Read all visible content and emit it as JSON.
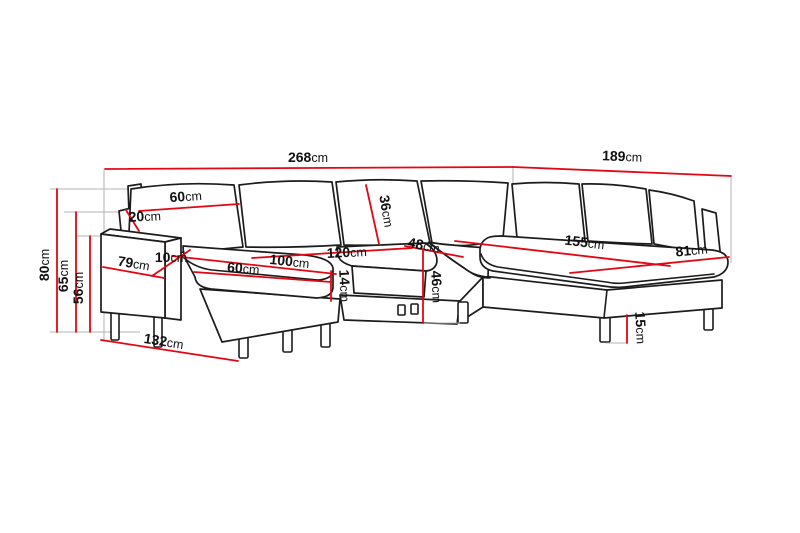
{
  "diagram": {
    "title": "corner-sofa-dimension-drawing",
    "unit": "cm",
    "colors": {
      "outline": "#1c1c1c",
      "dimension_line": "#e30613",
      "extension_line": "#b3b3b3",
      "label_text": "#111111",
      "background": "#ffffff"
    }
  },
  "dimensions": {
    "overall_width": {
      "value": "268",
      "unit": "cm"
    },
    "right_section_length": {
      "value": "189",
      "unit": "cm"
    },
    "overall_height": {
      "value": "80",
      "unit": "cm"
    },
    "back_height": {
      "value": "65",
      "unit": "cm"
    },
    "armrest_height": {
      "value": "56",
      "unit": "cm"
    },
    "back_cushion_width": {
      "value": "60",
      "unit": "cm"
    },
    "wing_height": {
      "value": "20",
      "unit": "cm"
    },
    "armrest_width": {
      "value": "10",
      "unit": "cm"
    },
    "armrest_length": {
      "value": "79",
      "unit": "cm"
    },
    "chaise_width": {
      "value": "60",
      "unit": "cm"
    },
    "chaise_seat_length": {
      "value": "100",
      "unit": "cm"
    },
    "middle_seat_width": {
      "value": "120",
      "unit": "cm"
    },
    "seat_depth": {
      "value": "48",
      "unit": "cm"
    },
    "back_cushion_height": {
      "value": "36",
      "unit": "cm"
    },
    "seat_cushion_thickness": {
      "value": "14",
      "unit": "cm"
    },
    "seat_height": {
      "value": "46",
      "unit": "cm"
    },
    "right_seat_length": {
      "value": "155",
      "unit": "cm"
    },
    "right_section_depth": {
      "value": "81",
      "unit": "cm"
    },
    "leg_height": {
      "value": "15",
      "unit": "cm"
    },
    "chaise_total_length": {
      "value": "132",
      "unit": "cm"
    }
  }
}
